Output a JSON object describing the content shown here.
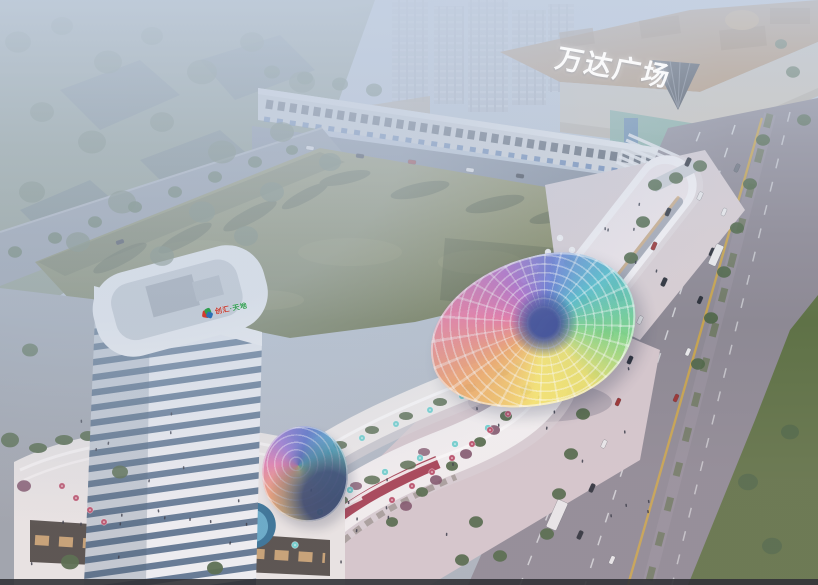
{
  "scene": {
    "title": "Aerial dusk rendering of a mixed-use retail development beside Wanda Plaza",
    "mall_sign": "万达广场",
    "tower_logo": {
      "text_left": "创汇",
      "text_right": "·天地",
      "text_left_color": "#c8382c",
      "text_right_color": "#2f9e4f",
      "mark_colors": [
        "#d23a2e",
        "#2f9e4f",
        "#2b6fb5"
      ]
    },
    "palette": {
      "sky_top": "#c3cedd",
      "sky_bottom": "#a9b2bc",
      "haze": "#c6d2e4",
      "park_green": "#7d8b72",
      "park_tree": "#5f7257",
      "block_mass": "#465862",
      "field_light": "#90905f",
      "field_dark": "#67714a",
      "shadow_green": "#3e4a2e",
      "field_mottle": "#9a9a68",
      "road": "#8d8994",
      "road_top": "#7e8796",
      "road_left": "#8b939e",
      "lane_white": "#d8dade",
      "lane_yellow": "#cfa845",
      "lawn": "#5f7247",
      "tree_green": "#4e6647",
      "tree_plum": "#7a4f66",
      "mall_roof": "#b5916c",
      "mall_facade": "#cdc6ba",
      "mall_glass": "#7fae9f",
      "mall_cone": "#3c4149",
      "distant_tower": "#b6bdc9",
      "shops_row": "#d4d6da",
      "tower_white": "#f3f5f7",
      "tower_glass": "#5a7490",
      "tower_roof": "#c7cdd3",
      "podium": "#e8e5e4",
      "podium_glass": "#4e4a46",
      "podium_window": "#d9ae78",
      "pool": "#2f6e94",
      "pool_inner": "#5fa8c8",
      "strip_white": "#f1eff0",
      "strip_upper": "#eceae9",
      "ribbon_red": "#9c2f44",
      "plaza_pink": "#d3c6cc",
      "plaza_gray": "#9aa1aa",
      "oval_plaza": "#d7cdd2",
      "oval_roof": "#f3f1f4",
      "umbrella_teal": "#6fd0cf",
      "umbrella_red": "#b8506a",
      "umbrella_white": "#f2f2f4",
      "people": "#2e3340",
      "car_dark": "#2b303a",
      "car_white": "#e8e8ea",
      "car_red": "#993333",
      "car_gray": "#6d727c",
      "canopy_center": "#2e3f8f",
      "bottom_bar": "#1d2126"
    }
  }
}
